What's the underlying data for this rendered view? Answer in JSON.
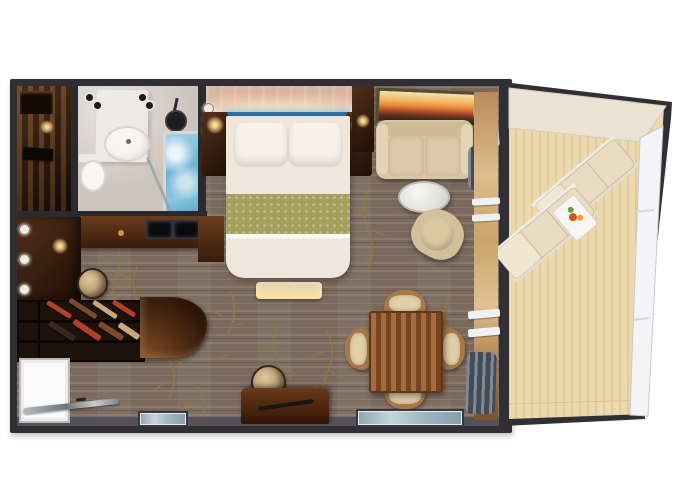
{
  "meta": {
    "type": "floor-plan",
    "subject": "cruise-ship-stateroom-top-down-rendering",
    "text_visible": "none"
  },
  "palette": {
    "page_bg": "#ffffff",
    "wall": "#303034",
    "wall_inner_band": "#53525a",
    "carpet": "#7b695d",
    "vine": "#8f7c3c",
    "entry_floor": "#30190b",
    "bathroom_floor": "#ccc5bd",
    "fixture_white": "#f8f6f3",
    "tub_water": "#84c1dd",
    "shower_head": "#1d1d1f",
    "glass_partition": "#9aa4a8",
    "headboard_wall": "#d9b6a2",
    "accent_blue": "#2d6ea6",
    "duvet": "#efe7dd",
    "pillow": "#f7f1e9",
    "runner_green": "#a4a15f",
    "bench": "#e5d5b5",
    "nightstand_wood": "#4a2a14",
    "closet_dark_wood": "#241510",
    "lamp_glow": "#ffd98f",
    "sofa": "#d9c6a4",
    "artwork_gold": "#f2b862",
    "artwork_rust": "#b3502a",
    "artwork_frame_green": "#6a7a3a",
    "curtain": "#5d6876",
    "blanket": "#dfe7ec",
    "coffee_table": "#eeeeec",
    "armchair": "#d3bf9c",
    "stool": "#cfb68d",
    "shelf_bg": "#1d120c",
    "shelf_item_red": "#b04028",
    "shelf_item_brown": "#7a4a2e",
    "shelf_item_tan": "#c8a87c",
    "shelf_item_dark": "#3c261a",
    "counter_wood": "#4e2a12",
    "door_white": "#fbfbfb",
    "glass_bar": "#98a2a8",
    "desk_wood": "#4c2710",
    "desk_handle": "#161616",
    "dining_table_wood": "#8a4f24",
    "chair_seat": "#e2cfa8",
    "chair_frame": "#a87848",
    "window_glass": "#a9bec7",
    "balcony_deck": "#ecd9ad",
    "deck_plank_line": "#d9c08f",
    "hull_overhang": "#eae2d3",
    "railing_white": "#f4f4f6",
    "lounger": "#e9dcc2",
    "lounger_back": "#f1e6d0",
    "lounger_frame": "#ececee",
    "balcony_table": "#f7f6f3",
    "flower_red": "#d85020",
    "flower_orange": "#ef9f2e",
    "flower_leaf": "#6a9a40"
  },
  "rooms": [
    {
      "name": "entry-hall"
    },
    {
      "name": "bathroom"
    },
    {
      "name": "bedroom"
    },
    {
      "name": "living-dining-area"
    },
    {
      "name": "balcony"
    }
  ],
  "furniture_inventory": {
    "bathroom": [
      "vanity-counter",
      "sink-basin",
      "toilet",
      "bathtub",
      "shower-head",
      "glass-partition",
      "ceiling-lights"
    ],
    "bedroom": [
      "queen-bed",
      "pillow-left",
      "pillow-right",
      "green-runner",
      "headboard-accent-bar",
      "nightstand-left",
      "nightstand-right",
      "wall-sconces",
      "foot-bench",
      "tv-console"
    ],
    "living_dining": [
      "sofa",
      "sunset-artwork",
      "coffee-table",
      "swivel-chair",
      "dining-table",
      "dining-chairs-x4",
      "writing-desk",
      "desk-stool",
      "vanity-stool",
      "wardrobe",
      "shoe-shelf-unit",
      "curved-counter",
      "entry-door",
      "glass-shelf",
      "curtains",
      "picture-window"
    ],
    "balcony": [
      "chaise-lounger-1",
      "chaise-lounger-2",
      "side-table",
      "flower-vase",
      "white-railing",
      "wood-deck",
      "hull-overhang"
    ]
  },
  "counts": {
    "dining_chairs": 4,
    "loungers": 2,
    "pillows": 2,
    "windows": 2
  }
}
